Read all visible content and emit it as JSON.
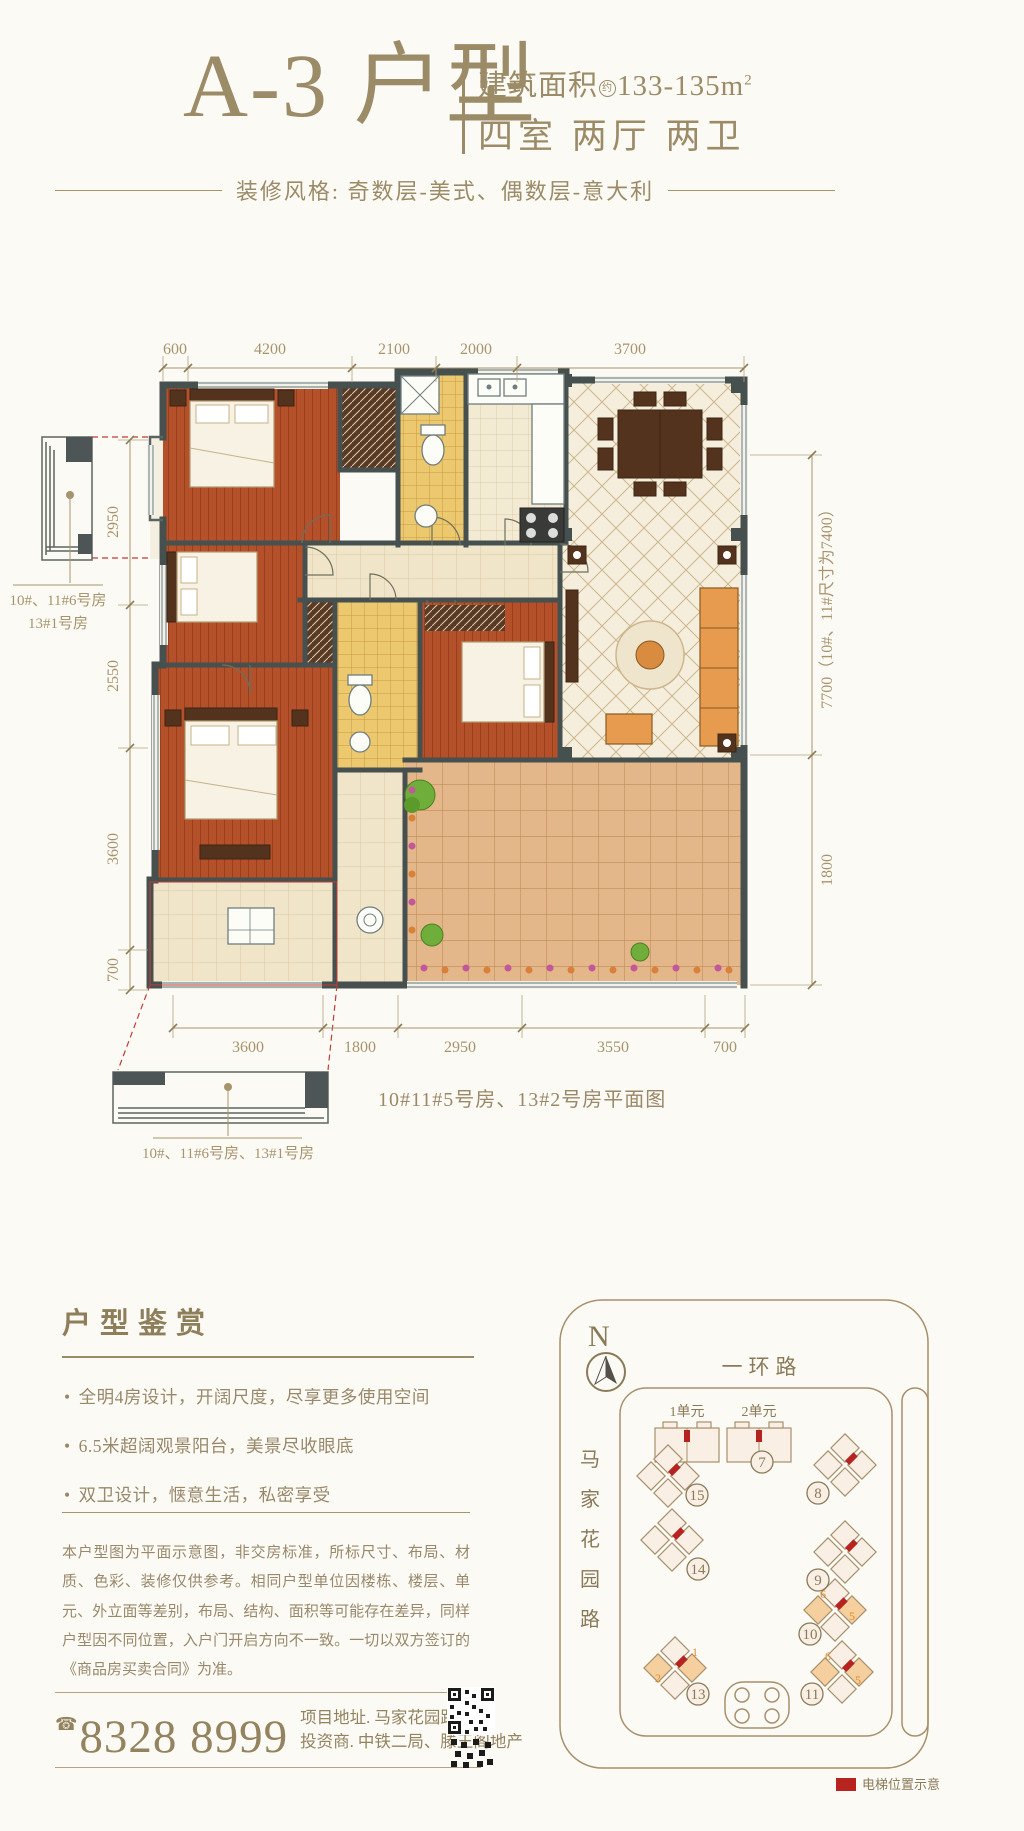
{
  "colors": {
    "accent": "#9c8b67",
    "dim_text": "#a8946c",
    "wall": "#46504f",
    "wood": "#b4512b",
    "bath_tile": "#ecc86e",
    "red": "#c43b33",
    "map_bg": "#f9efe5",
    "elevator_red": "#b7231f"
  },
  "header": {
    "title": "A-3 户型",
    "area_label": "建筑面积",
    "area_approx": "约",
    "area_value": "133-135m",
    "area_sup": "2",
    "rooms": "四室 两厅 两卫",
    "style_line": "装修风格: 奇数层-美式、偶数层-意大利"
  },
  "plan": {
    "dims_top": [
      "600",
      "4200",
      "2100",
      "2000",
      "3700"
    ],
    "dims_left": [
      "2950",
      "2550",
      "3600",
      "700"
    ],
    "dim_right_main": "7700（10#、11#尺寸为7400）",
    "dim_right_sub": "1800",
    "dims_bottom": [
      "3600",
      "1800",
      "2950",
      "3550",
      "700"
    ],
    "bay_top_label_line1": "10#、11#6号房",
    "bay_top_label_line2": "13#1号房",
    "bay_bottom_label": "10#、11#6号房、13#1号房",
    "caption": "10#11#5号房、13#2号房平面图"
  },
  "review": {
    "title": "户型鉴赏",
    "bullets": [
      "全明4房设计，开阔尺度，尽享更多使用空间",
      "6.5米超阔观景阳台，美景尽收眼底",
      "双卫设计，惬意生活，私密享受"
    ]
  },
  "disclaimer": "本户型图为平面示意图，非交房标准，所标尺寸、布局、材质、色彩、装修仅供参考。相同户型单位因楼栋、楼层、单元、外立面等差别，布局、结构、面积等可能存在差异，同样户型因不同位置，入户门开启方向不一致。一切以双方签订的《商品房买卖合同》为准。",
  "footer": {
    "phone": "8328 8999",
    "address1": "项目地址. 马家花园路16号",
    "address2": "投资商. 中铁二局、滕王阁地产"
  },
  "map": {
    "north": "N",
    "road_top": "一环路",
    "road_left": [
      "马",
      "家",
      "花",
      "园",
      "路"
    ],
    "unit_labels": [
      "1单元",
      "2单元"
    ],
    "buildings": {
      "b7": "7",
      "b8": "8",
      "b9": "9",
      "b10": "10",
      "b11": "11",
      "b13": "13",
      "b14": "14",
      "b15": "15"
    },
    "unit_marks": {
      "m10a": "6",
      "m10b": "5",
      "m13a": "1",
      "m13b": "2",
      "m11a": "6",
      "m11b": "5"
    },
    "legend": "电梯位置示意"
  }
}
